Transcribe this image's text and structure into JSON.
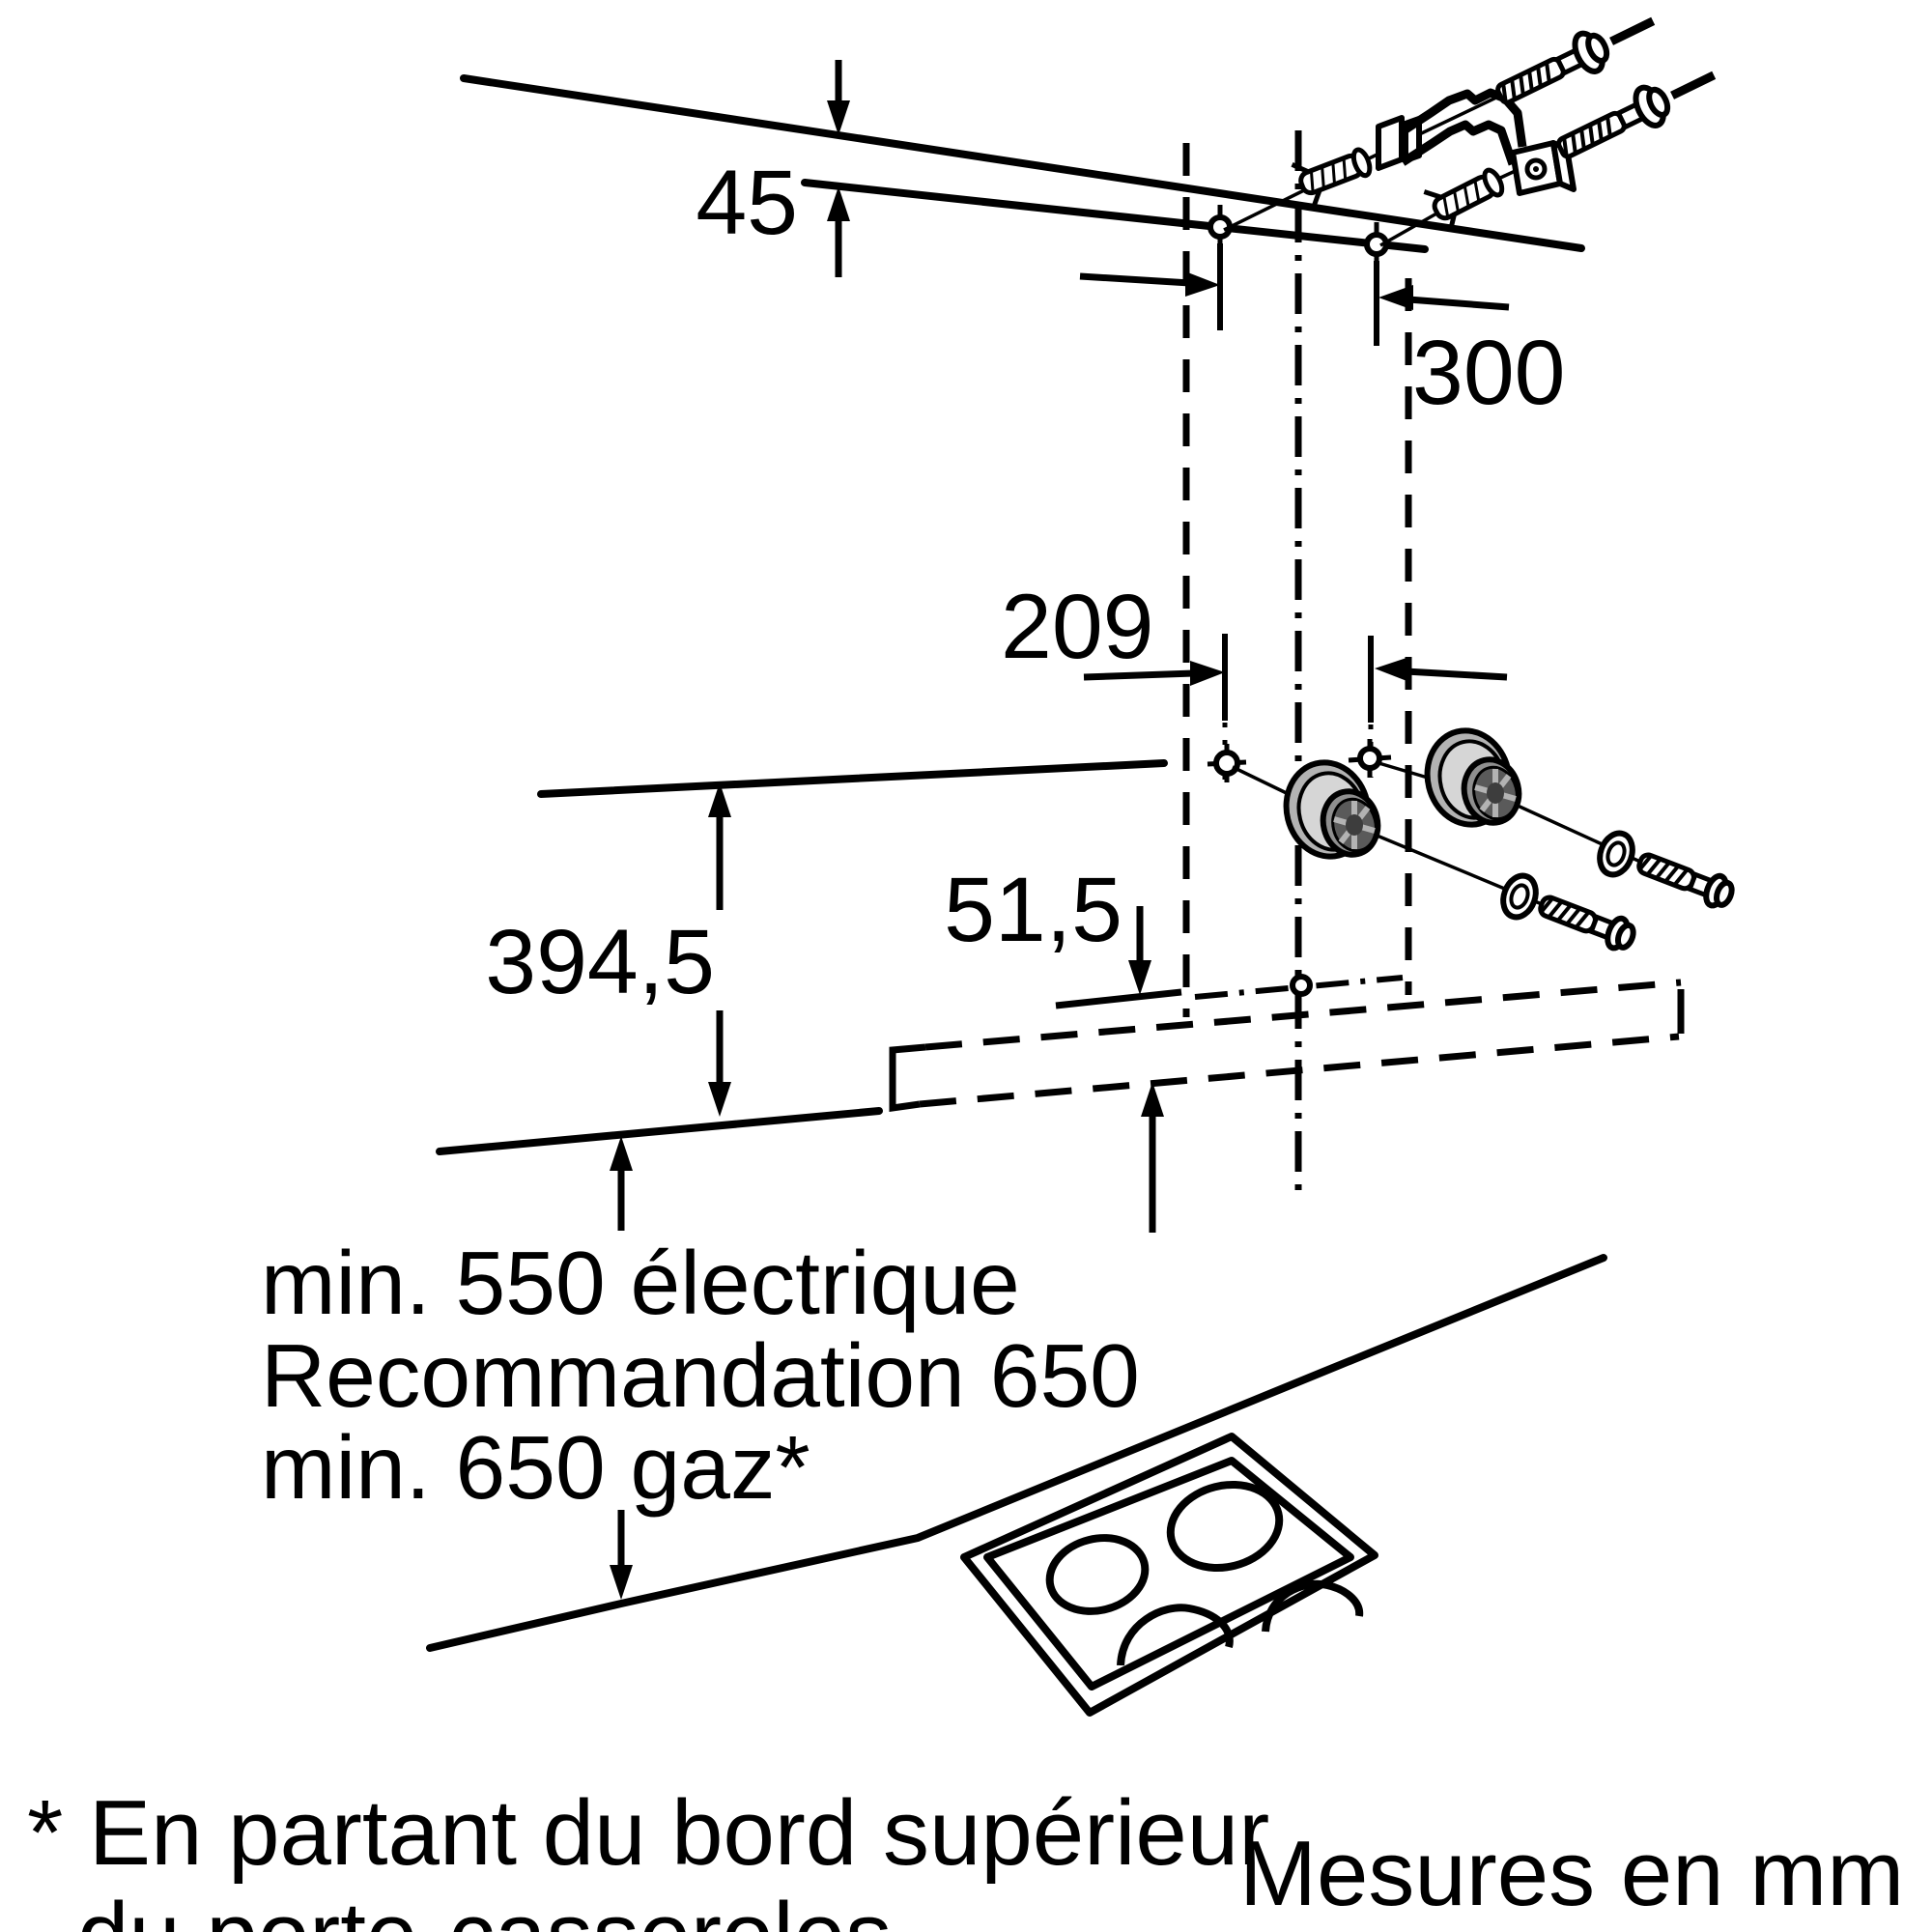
{
  "diagram": {
    "type": "installation-drawing",
    "subject": "wall-mounted cooker hood mounting dimensions",
    "units_note": "Mesures en mm",
    "dims": {
      "ceiling_offset": "45",
      "hole_spacing_top": "300",
      "hole_spacing_bottom": "209",
      "mount_height": "394,5",
      "duct_offset": "51,5"
    },
    "clearance": [
      "min. 550 électrique",
      "Recommandation 650",
      "min. 650 gaz*"
    ],
    "footnote": [
      "* En partant du bord supérieur",
      "du porte-casseroles"
    ],
    "colors": {
      "line": "#000000",
      "background": "#ffffff",
      "spacer_flange": "#b3b3b3",
      "spacer_rim": "#d6d6d6",
      "spacer_face": "#8f8f8f",
      "spacer_core": "#5a5a5a",
      "spacer_hole": "#3d3d3d"
    }
  }
}
